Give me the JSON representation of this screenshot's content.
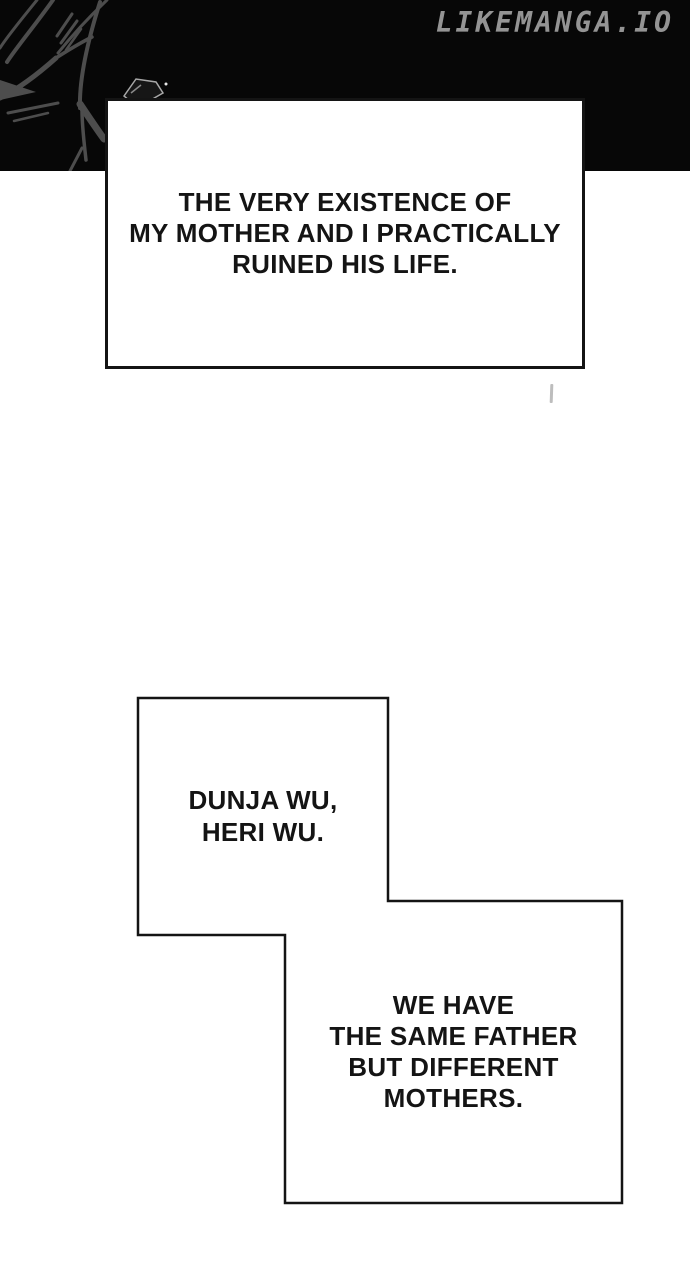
{
  "page": {
    "watermark": "LIKEMANGA.IO"
  },
  "captions": {
    "box1": "THE VERY EXISTENCE OF\nMY MOTHER AND I PRACTICALLY\nRUINED HIS LIFE.",
    "box2": "DUNJA WU,\nHERI WU.",
    "box3": "WE HAVE\nTHE SAME FATHER\nBUT DIFFERENT\nMOTHERS."
  },
  "artwork": {
    "top_left_line_art": "abstract gray branch sketch on black background",
    "small_doodle": "tiny angular box sketch at band bottom",
    "stray_mark": "faint gray dash below first caption box"
  },
  "colors": {
    "band_black": "#070707",
    "paper_white": "#ffffff",
    "ink_black": "#141414",
    "watermark_gray": "#949494",
    "line_art_gray": "#4d4d4d"
  }
}
